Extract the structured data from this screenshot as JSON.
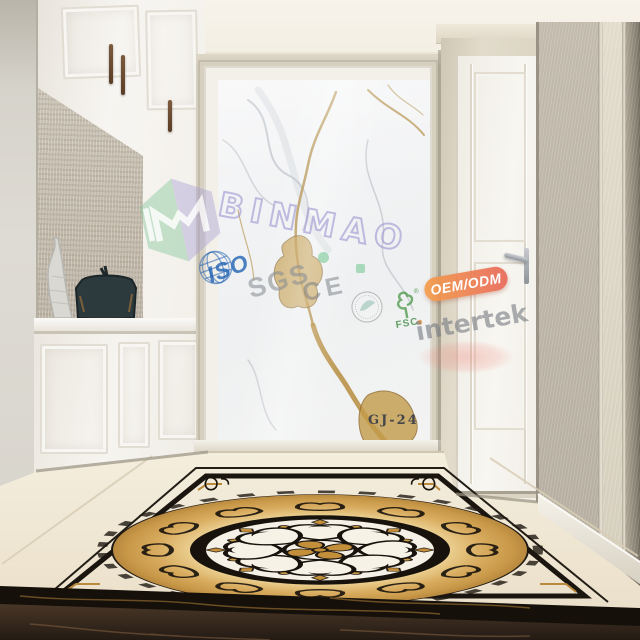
{
  "scene": {
    "product_code": "GJ-24"
  },
  "watermarks": {
    "brand": "BINMAO",
    "iso": "ISO",
    "sgs": "SGS",
    "ce": "CE",
    "fsc": "FSC",
    "oem_odm": "OEM/ODM",
    "intertek": "intertek"
  },
  "colors": {
    "brand_green": "#7ac698",
    "brand_lavender": "#a9a2d8",
    "iso_blue": "#1c60b2",
    "oem_orange": "#f49c4a",
    "oem_red": "#e86758",
    "fsc_green": "#408c42",
    "marble_gold_vein": "#b68d3f",
    "medallion_gold": "#c89944",
    "emperador_brown": "#3d2f23"
  }
}
